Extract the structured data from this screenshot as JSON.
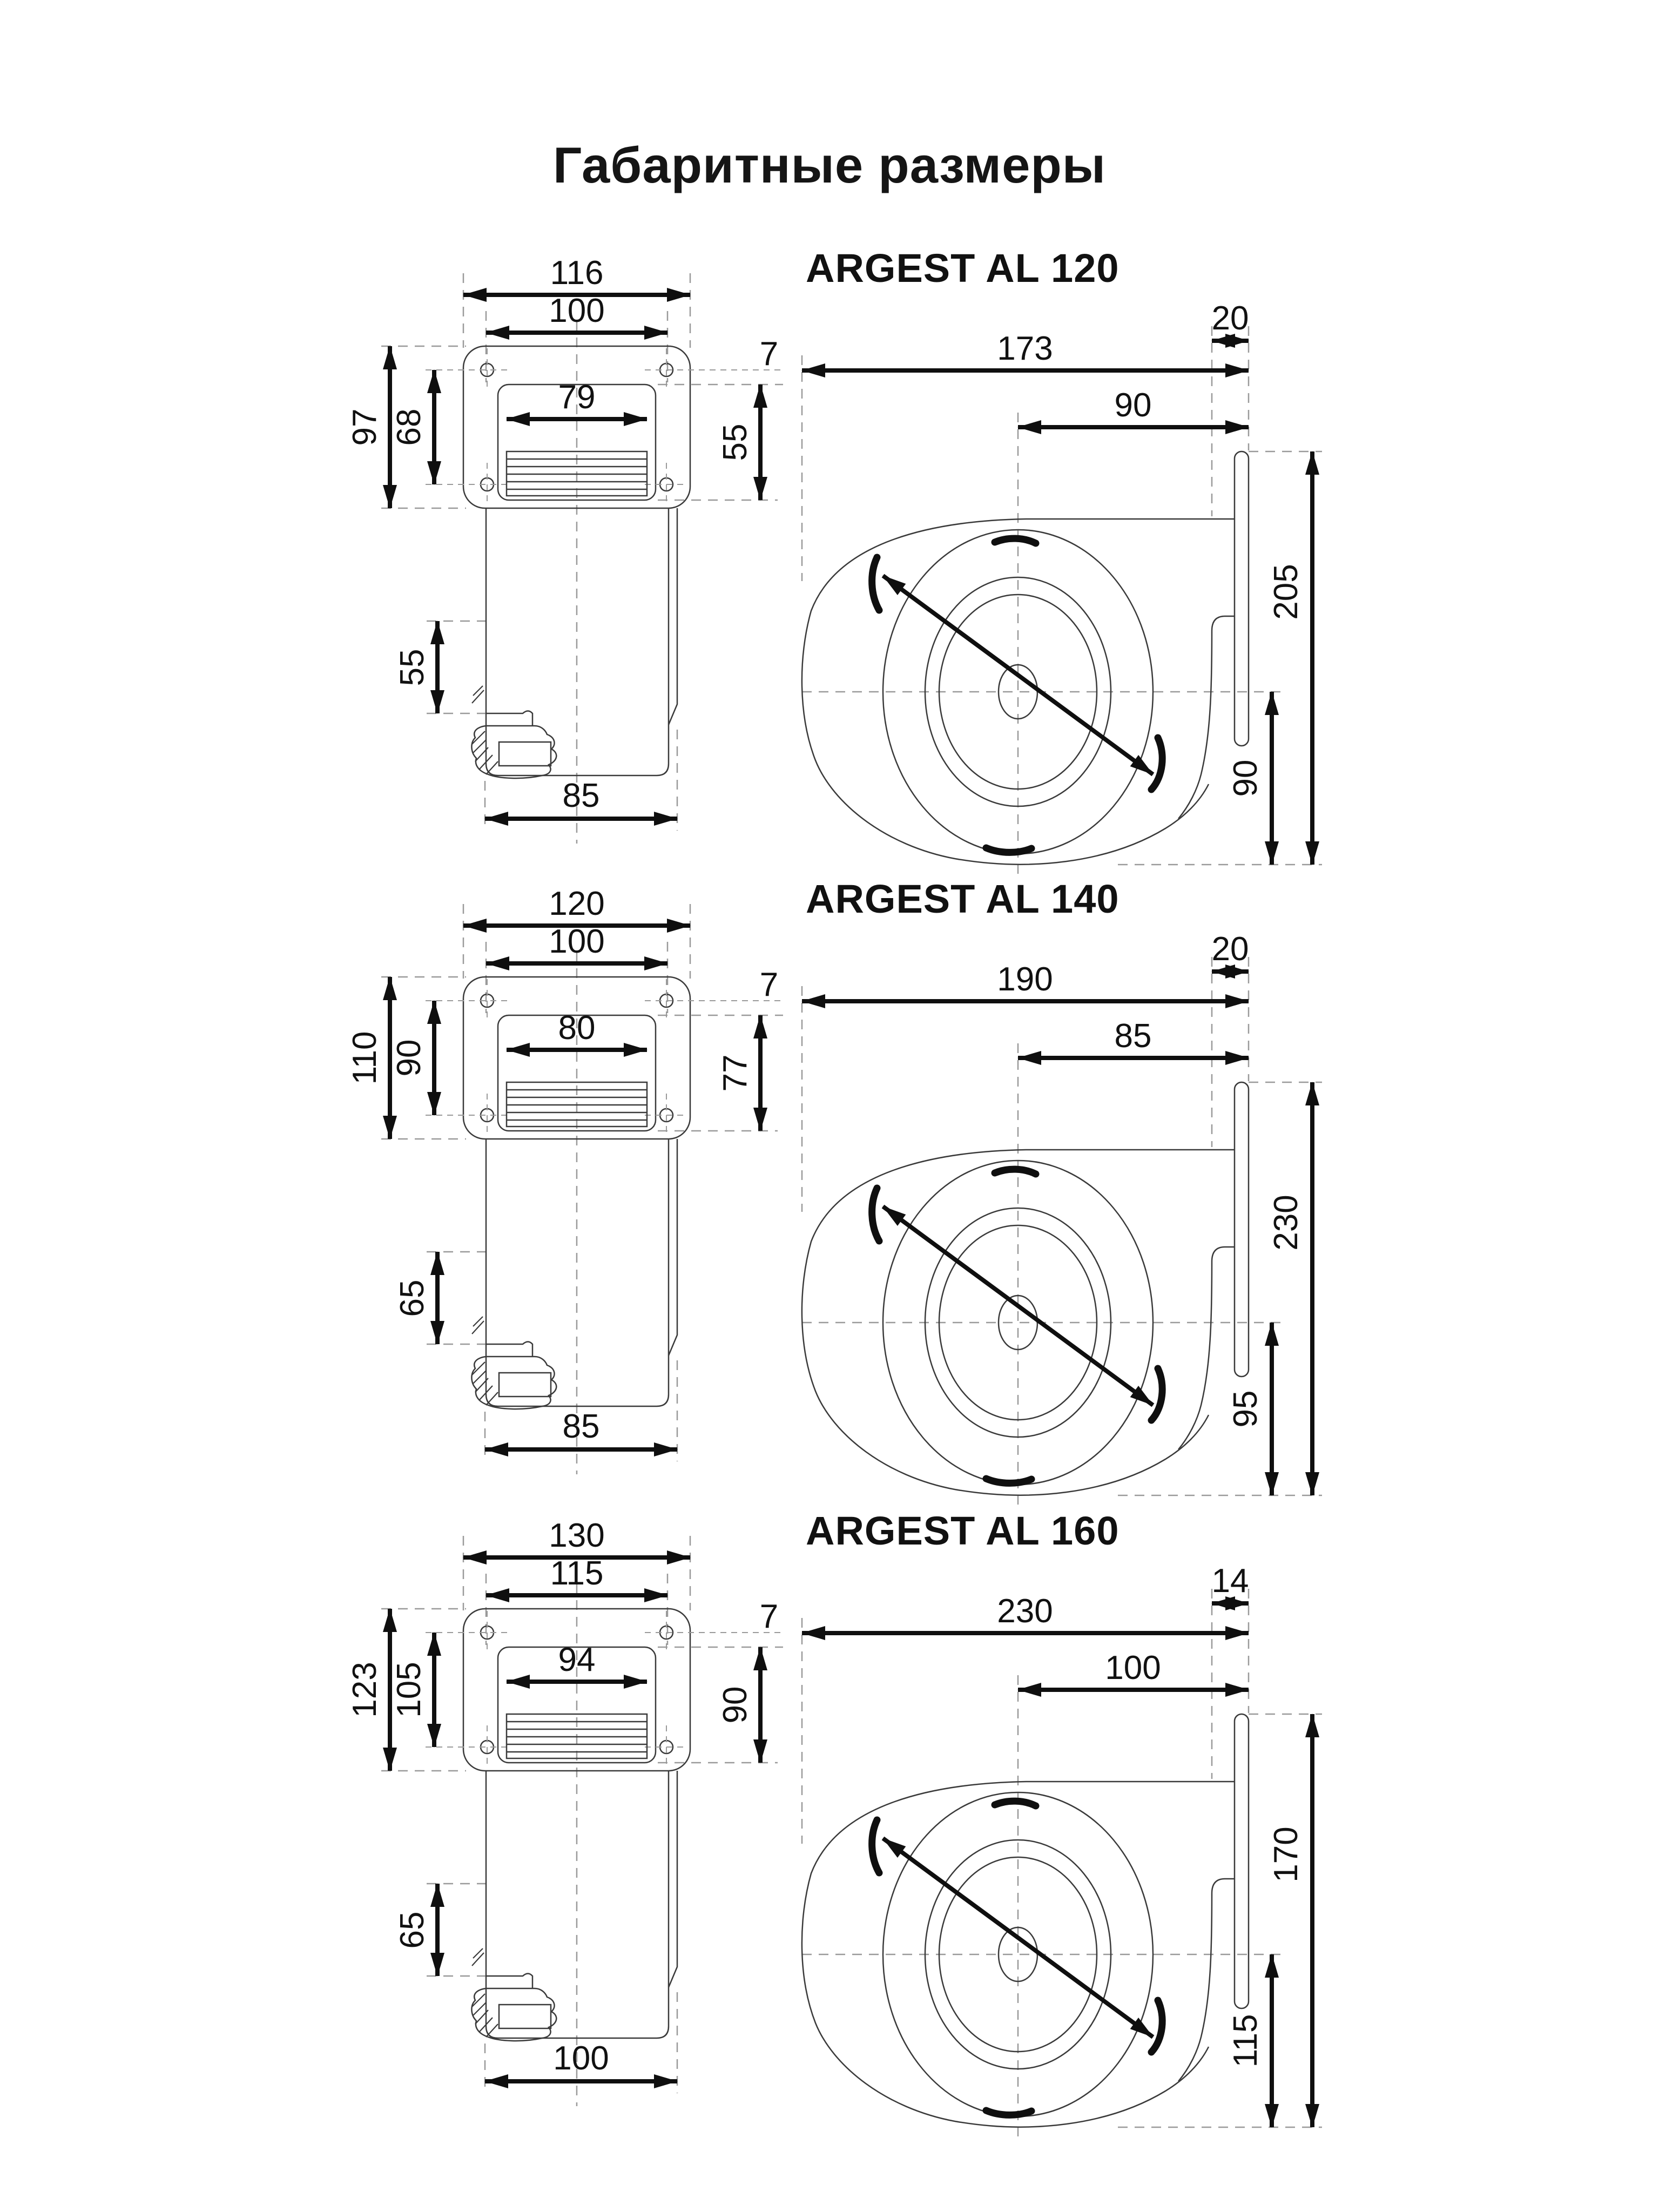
{
  "page": {
    "title": "Габаритные размеры"
  },
  "colors": {
    "background": "#ffffff",
    "line": "#3a3a3a",
    "dimension": "#0f0f0f",
    "dashed": "#9a9a9a"
  },
  "models": [
    {
      "name": "ARGEST AL 120",
      "front": {
        "width_outer": "116",
        "width_holes": "100",
        "width_opening": "79",
        "height_outer": "97",
        "height_holes": "68",
        "height_opening": "55",
        "hole_offset": "7",
        "body_height": "55",
        "body_width": "85"
      },
      "side": {
        "width_overall": "173",
        "flange_overhang": "20",
        "center_to_flange": "90",
        "height_overall": "205",
        "center_to_bottom": "90"
      }
    },
    {
      "name": "ARGEST AL 140",
      "front": {
        "width_outer": "120",
        "width_holes": "100",
        "width_opening": "80",
        "height_outer": "110",
        "height_holes": "90",
        "height_opening": "77",
        "hole_offset": "7",
        "body_height": "65",
        "body_width": "85"
      },
      "side": {
        "width_overall": "190",
        "flange_overhang": "20",
        "center_to_flange": "85",
        "height_overall": "230",
        "center_to_bottom": "95"
      }
    },
    {
      "name": "ARGEST AL 160",
      "front": {
        "width_outer": "130",
        "width_holes": "115",
        "width_opening": "94",
        "height_outer": "123",
        "height_holes": "105",
        "height_opening": "90",
        "hole_offset": "7",
        "body_height": "65",
        "body_width": "100"
      },
      "side": {
        "width_overall": "230",
        "flange_overhang": "14",
        "center_to_flange": "100",
        "height_overall": "170",
        "center_to_bottom": "115"
      }
    }
  ]
}
